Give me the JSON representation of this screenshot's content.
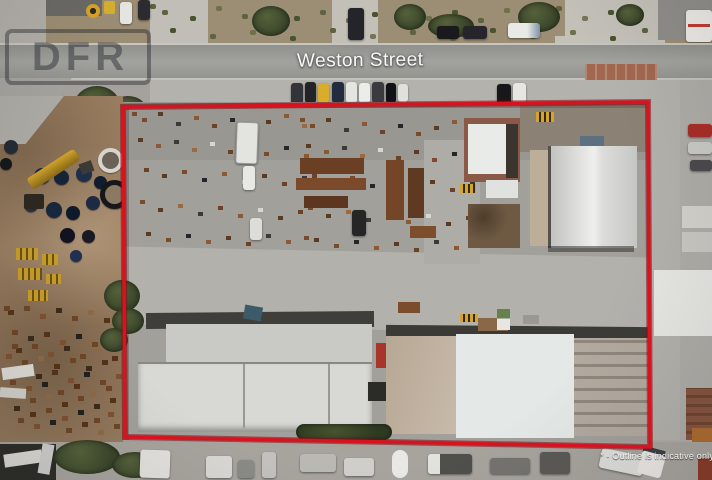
{
  "labels": {
    "street": "Weston Street",
    "watermark": "DFR",
    "disclaimer": "* - Outline is indicative only"
  },
  "colors": {
    "outline_red": "#d6131f",
    "watermark_tint": "rgba(25,28,36,0.42)",
    "road_gray": "#9a9a96"
  }
}
